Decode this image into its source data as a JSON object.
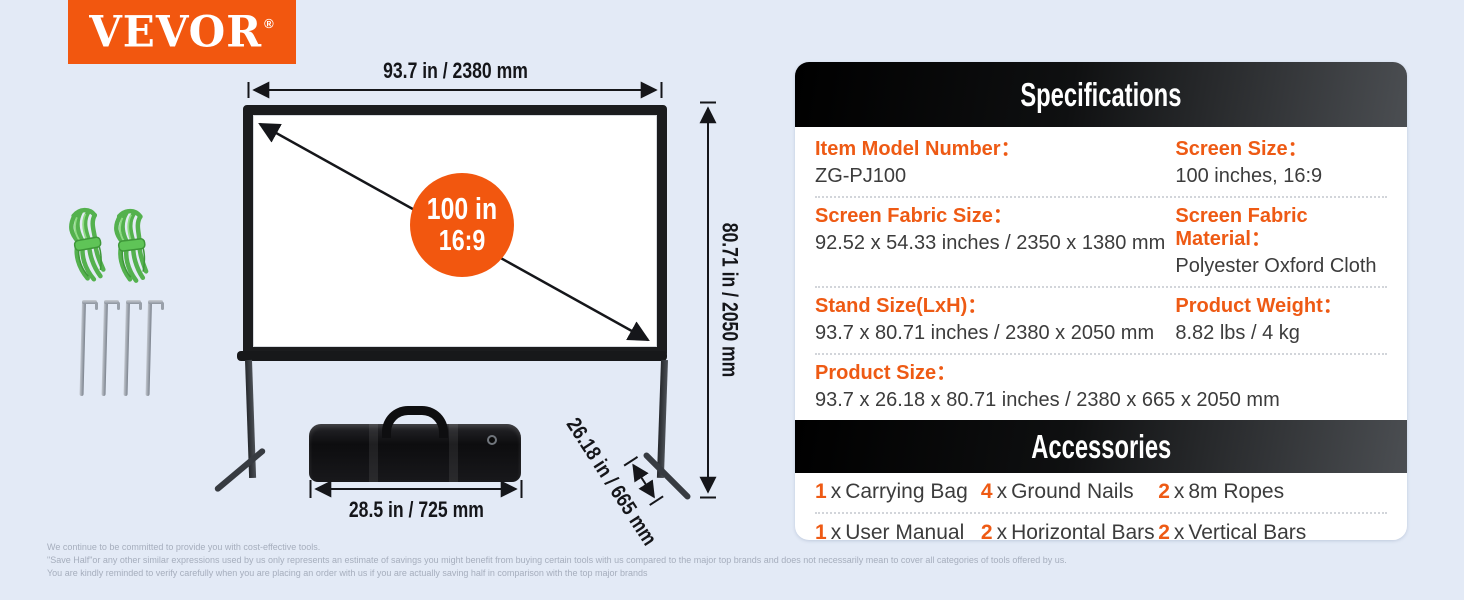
{
  "brand": {
    "name": "VEVOR",
    "registered_mark": "®"
  },
  "colors": {
    "accent_orange": "#F2570F",
    "label_orange": "#EE5A14",
    "header_black": "#0f1011",
    "page_background": "#E3EAF6",
    "rope_green": "#54B14E"
  },
  "diagram": {
    "screen_width_label": "93.7 in / 2380 mm",
    "screen_height_label": "80.71 in / 2050 mm",
    "stand_depth_label": "26.18 in / 665 mm",
    "bag_width_label": "28.5 in / 725 mm",
    "badge": {
      "line1": "100 in",
      "line2": "16:9"
    }
  },
  "specifications": {
    "title": "Specifications",
    "rows": [
      {
        "label": "Item Model Number：",
        "value": "ZG-PJ100"
      },
      {
        "label": "Screen Size：",
        "value": "100 inches, 16:9"
      },
      {
        "label": "Screen Fabric Size：",
        "value": "92.52 x 54.33 inches / 2350 x 1380 mm"
      },
      {
        "label": "Screen Fabric Material：",
        "value": "Polyester Oxford Cloth"
      },
      {
        "label": "Stand Size(LxH)：",
        "value": "93.7 x 80.71 inches / 2380 x 2050 mm"
      },
      {
        "label": "Product Weight：",
        "value": "8.82 lbs / 4 kg"
      },
      {
        "label": "Product Size：",
        "value": "93.7 x 26.18 x 80.71 inches / 2380 x 665 x 2050 mm"
      }
    ]
  },
  "accessories": {
    "title": "Accessories",
    "separator": "x",
    "items": [
      {
        "qty": "1",
        "name": "Carrying Bag"
      },
      {
        "qty": "4",
        "name": "Ground Nails"
      },
      {
        "qty": "2",
        "name": "8m Ropes"
      },
      {
        "qty": "1",
        "name": "User Manual"
      },
      {
        "qty": "2",
        "name": "Horizontal Bars"
      },
      {
        "qty": "2",
        "name": "Vertical Bars"
      },
      {
        "qty": "2",
        "name": "Bar Feet"
      }
    ]
  },
  "disclaimer": {
    "line1": "We continue to be committed to provide you with cost-effective tools.",
    "line2": "\"Save Half\"or any other similar expressions used by us only represents an estimate of savings you might benefit from buying certain tools with us compared to the major top brands and does not necessarily mean to cover all categories of tools offered by us.",
    "line3": "You are kindly reminded to verify carefully when you are placing an order with us if you are actually saving half in comparison with the top major brands"
  }
}
